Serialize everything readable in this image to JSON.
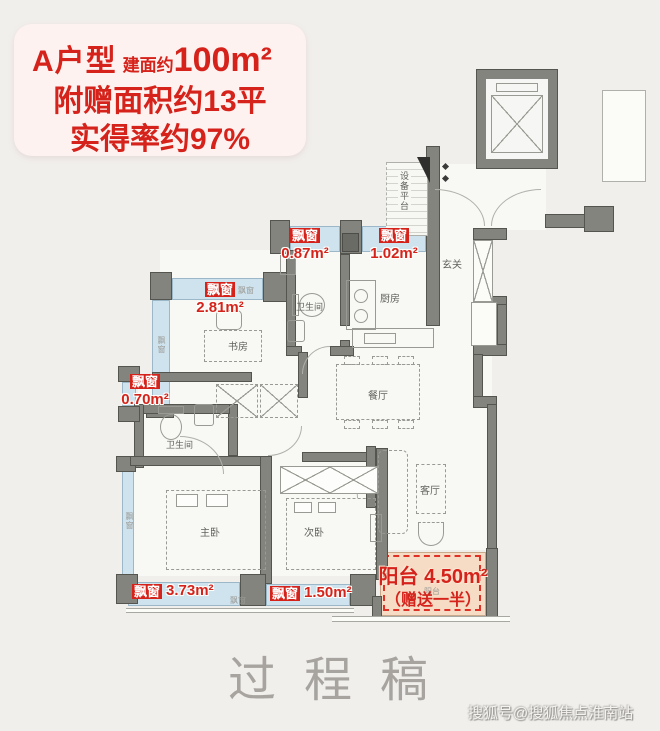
{
  "header": {
    "type_name": "A户型",
    "area_label": "建面约",
    "area_value": "100m²",
    "bonus_line": "附赠面积约13平",
    "rate_line": "实得率约97%"
  },
  "floorplan": {
    "bay_window_tag": "飘窗",
    "bay_windows": {
      "bath_top": {
        "tag": "飘窗",
        "value": "0.87m²"
      },
      "kitchen_top": {
        "tag": "飘窗",
        "value": "1.02m²"
      },
      "study_top": {
        "tag": "飘窗",
        "value": "2.81m²"
      },
      "bath2_left": {
        "tag": "飘窗",
        "value": "0.70m²"
      },
      "master_bottom": {
        "tag": "飘窗",
        "value": "3.73m²"
      },
      "second_bottom": {
        "tag": "飘窗",
        "value": "1.50m²"
      }
    },
    "balcony": {
      "title": "阳台 4.50m²",
      "note": "（赠送一半）",
      "tiny_label": "阳台"
    },
    "rooms": {
      "equipment": "设备平台",
      "entry": "玄关",
      "kitchen": "厨房",
      "bath1": "卫生间",
      "study": "书房",
      "dining": "餐厅",
      "bath2": "卫生间",
      "living": "客厅",
      "master": "主卧",
      "second": "次卧"
    }
  },
  "watermark": {
    "draft": "过程稿",
    "credit": "搜狐号@搜狐焦点淮南站"
  },
  "colors": {
    "accent_red": "#d5231b",
    "window_blue": "#cfe3ef",
    "balcony_peach": "#f7dcc5",
    "wall_gray": "#84847e",
    "page_bg": "#f1efec"
  }
}
